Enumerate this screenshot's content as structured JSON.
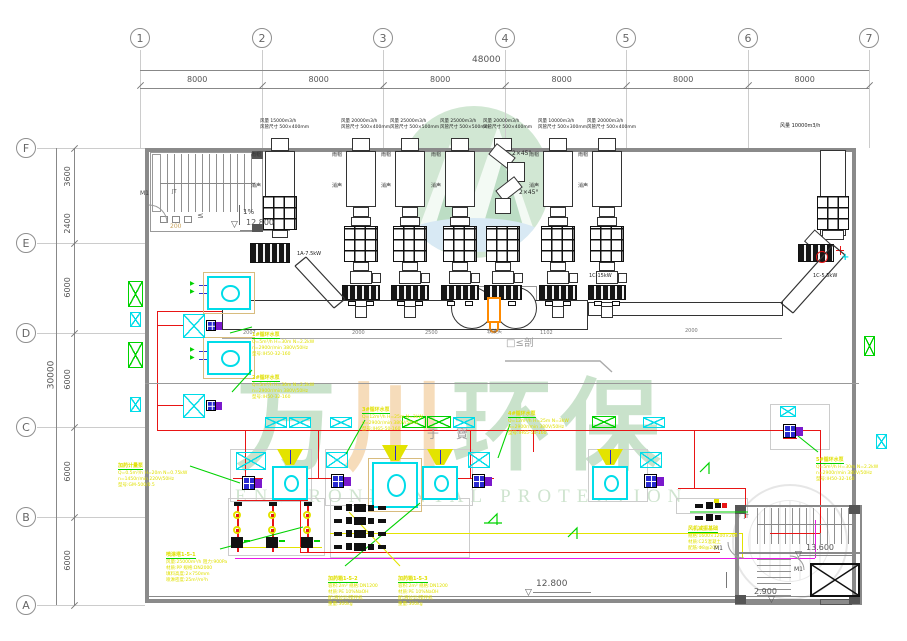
{
  "grid": {
    "cols": [
      {
        "label": "1",
        "x": 140
      },
      {
        "label": "2",
        "x": 262
      },
      {
        "label": "3",
        "x": 383
      },
      {
        "label": "4",
        "x": 505
      },
      {
        "label": "5",
        "x": 626
      },
      {
        "label": "6",
        "x": 748
      },
      {
        "label": "7",
        "x": 869
      }
    ],
    "col_dims": [
      "8000",
      "8000",
      "8000",
      "8000",
      "8000",
      "8000"
    ],
    "col_total": "48000",
    "rows": [
      {
        "label": "F",
        "y": 148
      },
      {
        "label": "E",
        "y": 243
      },
      {
        "label": "D",
        "y": 333
      },
      {
        "label": "C",
        "y": 427
      },
      {
        "label": "B",
        "y": 517
      },
      {
        "label": "A",
        "y": 605
      }
    ],
    "row_dims": [
      {
        "label": "3600",
        "y1": 148,
        "y2": 205
      },
      {
        "label": "2400",
        "y1": 205,
        "y2": 243
      },
      {
        "label": "6000",
        "y1": 243,
        "y2": 333
      },
      {
        "label": "6000",
        "y1": 333,
        "y2": 427
      },
      {
        "label": "6000",
        "y1": 427,
        "y2": 517
      },
      {
        "label": "6000",
        "y1": 517,
        "y2": 605
      }
    ],
    "row_total": "30000"
  },
  "watermark": {
    "cn": [
      {
        "ch": "万",
        "x": 236,
        "color": "#c9e2cb"
      },
      {
        "ch": "川",
        "x": 344,
        "color": "#f6dcba"
      },
      {
        "ch": "环",
        "x": 452,
        "color": "#c9e2cb"
      },
      {
        "ch": "保",
        "x": 560,
        "color": "#c9e2cb"
      }
    ],
    "en": "ENVIRONMENTAL PROTECTION"
  },
  "tower_side": [
    "雨帽",
    "消声"
  ],
  "towers": [
    {
      "x": 280,
      "flow": "风量 15000m3/h",
      "duct": "风管尺寸 500×400mm",
      "type": "short"
    },
    {
      "x": 361,
      "flow": "风量 20000m3/h",
      "duct": "风管尺寸 500×400mm",
      "type": "std"
    },
    {
      "x": 410,
      "flow": "风量 25000m3/h",
      "duct": "风管尺寸 500×500mm",
      "type": "std"
    },
    {
      "x": 460,
      "flow": "风量 25000m3/h",
      "duct": "风管尺寸 500×500mm",
      "type": "std"
    },
    {
      "x": 503,
      "flow": "风量 20000m3/h",
      "duct": "风管尺寸 500×400mm",
      "type": "bend"
    },
    {
      "x": 558,
      "flow": "风量 10000m3/h",
      "duct": "风管尺寸 500×300mm",
      "type": "std"
    },
    {
      "x": 607,
      "flow": "风量 20000m3/h",
      "duct": "风管尺寸 500×400mm",
      "type": "std"
    }
  ],
  "texts": [
    {
      "n": "stair1-door-label",
      "t": "M1",
      "x": 140,
      "y": 191,
      "s": 6,
      "c": "#444"
    },
    {
      "n": "stair1-label",
      "t": "JT",
      "x": 172,
      "y": 190,
      "s": 5,
      "c": "#555"
    },
    {
      "n": "stair1-leq",
      "t": "≤",
      "x": 197,
      "y": 212,
      "s": 8,
      "c": "#666"
    },
    {
      "n": "stair1-num",
      "t": "200",
      "x": 170,
      "y": 224,
      "s": 6,
      "c": "#c8a25a"
    },
    {
      "n": "slope-label",
      "t": "1%",
      "x": 243,
      "y": 209,
      "s": 7,
      "c": "#444"
    },
    {
      "n": "elevation-stair1",
      "t": "12.800",
      "x": 246,
      "y": 219,
      "s": 8,
      "c": "#555"
    },
    {
      "n": "elevation-bottom",
      "t": "12.800",
      "x": 536,
      "y": 580,
      "s": 9,
      "c": "#555"
    },
    {
      "n": "elevation-stair2-top",
      "t": "13.600",
      "x": 806,
      "y": 544,
      "s": 8,
      "c": "#555"
    },
    {
      "n": "elevation-stair2-mid",
      "t": "2.900",
      "x": 754,
      "y": 588,
      "s": 8,
      "c": "#555"
    },
    {
      "n": "stair2-door1-label",
      "t": "M1",
      "x": 714,
      "y": 546,
      "s": 6,
      "c": "#444"
    },
    {
      "n": "stair2-door2-label",
      "t": "M1",
      "x": 794,
      "y": 567,
      "s": 6,
      "c": "#444"
    },
    {
      "n": "stair2-label",
      "t": "JT",
      "x": 744,
      "y": 515,
      "s": 5,
      "c": "#555"
    },
    {
      "n": "fan-label-left",
      "t": "1A-7.5kW",
      "x": 297,
      "y": 252,
      "s": 5,
      "c": "#222"
    },
    {
      "n": "fan-label-tower",
      "t": "1C-15kW",
      "x": 589,
      "y": 274,
      "s": 5,
      "c": "#222"
    },
    {
      "n": "fan-label-right",
      "t": "1C-5.5kW",
      "x": 813,
      "y": 274,
      "s": 5,
      "c": "#222"
    },
    {
      "n": "right-duct-flow",
      "t": "风量 10000m3/h",
      "x": 780,
      "y": 124,
      "s": 5,
      "c": "#222"
    },
    {
      "n": "connector-label",
      "t": "软接头",
      "x": 487,
      "y": 330,
      "s": 5,
      "c": "#666"
    },
    {
      "n": "section-mark",
      "t": "□≤剖",
      "x": 506,
      "y": 338,
      "s": 10,
      "c": "#9c9c9c"
    },
    {
      "n": "gray-glyph-1",
      "t": "于",
      "x": 427,
      "y": 428,
      "s": 12,
      "c": "#9c9c9c"
    },
    {
      "n": "gray-glyph-2",
      "t": "寶",
      "x": 456,
      "y": 428,
      "s": 12,
      "c": "#9c9c9c"
    },
    {
      "n": "duct-dim",
      "t": "2007",
      "x": 243,
      "y": 331,
      "s": 5,
      "c": "#777"
    },
    {
      "n": "duct-dim",
      "t": "2000",
      "x": 352,
      "y": 331,
      "s": 5,
      "c": "#777"
    },
    {
      "n": "duct-dim",
      "t": "2500",
      "x": 425,
      "y": 331,
      "s": 5,
      "c": "#777"
    },
    {
      "n": "duct-dim",
      "t": "1102",
      "x": 540,
      "y": 331,
      "s": 5,
      "c": "#777"
    },
    {
      "n": "duct-dim",
      "t": "2000",
      "x": 685,
      "y": 329,
      "s": 5,
      "c": "#777"
    },
    {
      "n": "bend-label",
      "t": "2×45°",
      "x": 512,
      "y": 151,
      "s": 6,
      "c": "#222"
    },
    {
      "n": "bend-label",
      "t": "2×45°",
      "x": 519,
      "y": 190,
      "s": 6,
      "c": "#222"
    },
    {
      "n": "elev-triangle",
      "t": "▽",
      "x": 231,
      "y": 221,
      "s": 9,
      "c": "#555"
    },
    {
      "n": "elev-triangle",
      "t": "▽",
      "x": 525,
      "y": 589,
      "s": 9,
      "c": "#555"
    },
    {
      "n": "elev-triangle",
      "t": "▽",
      "x": 795,
      "y": 551,
      "s": 9,
      "c": "#555"
    },
    {
      "n": "elev-triangle",
      "t": "▽",
      "x": 768,
      "y": 596,
      "s": 9,
      "c": "#555"
    },
    {
      "n": "cyan-plus",
      "t": "+",
      "x": 841,
      "y": 252,
      "s": 10,
      "c": "#00dce8",
      "b": 1
    },
    {
      "n": "green-arrow",
      "t": "▶",
      "x": 190,
      "y": 281,
      "s": 6,
      "c": "#00d200"
    },
    {
      "n": "green-arrow",
      "t": "▶",
      "x": 190,
      "y": 289,
      "s": 6,
      "c": "#00d200"
    },
    {
      "n": "green-arrow",
      "t": "▶",
      "x": 190,
      "y": 347,
      "s": 6,
      "c": "#00d200"
    },
    {
      "n": "green-arrow",
      "t": "▶",
      "x": 190,
      "y": 355,
      "s": 6,
      "c": "#00d200"
    }
  ],
  "annotations": [
    {
      "x": 252,
      "y": 321,
      "title": "1#循环水泵",
      "lines": [
        "Q=5m³/h H=30m N=2.2kW",
        "n=2900r/min 380V/50Hz",
        "型号:IH50-32-160"
      ]
    },
    {
      "x": 252,
      "y": 364,
      "title": "2#循环水泵",
      "lines": [
        "Q=5m³/h H=30m N=2.2kW",
        "n=2900r/min 380V/50Hz",
        "型号:IH50-32-160"
      ]
    },
    {
      "x": 118,
      "y": 452,
      "title": "加药计量泵",
      "lines": [
        "Q=0.5m³/h H=20m N=0.75kW",
        "n=1450r/min 220V/50Hz",
        "型号:GM-500/0.5"
      ]
    },
    {
      "x": 362,
      "y": 396,
      "title": "3#循环水泵",
      "lines": [
        "Q=12m³/h H=25m N=3kW",
        "n=2900r/min 380V/50Hz",
        "型号:IH65-50-160"
      ]
    },
    {
      "x": 508,
      "y": 400,
      "title": "4#循环水泵",
      "lines": [
        "Q=12m³/h H=25m N=3kW",
        "n=2900r/min 380V/50Hz",
        "型号:IH65-50-160"
      ]
    },
    {
      "x": 816,
      "y": 446,
      "title": "5#循环水泵",
      "lines": [
        "Q=5m³/h H=30m N=2.2kW",
        "n=2900r/min 380V/50Hz",
        "型号:IH50-32-160"
      ]
    },
    {
      "x": 166,
      "y": 541,
      "title": "喷淋塔1-5-1",
      "lines": [
        "风量:25000m³/h 阻力:900Pa",
        "材质:PP 规格:DN2000",
        "填料高度:2×750mm",
        "喷淋密度:25m³/m²h"
      ]
    },
    {
      "x": 328,
      "y": 565,
      "title": "加药箱1-5-2",
      "lines": [
        "容积:2m³ 规格:DN1200",
        "材质:PE 10%NaOH",
        "配:液位计/搅拌机",
        "重量:300kg"
      ]
    },
    {
      "x": 398,
      "y": 565,
      "title": "加药箱1-5-3",
      "lines": [
        "容积:2m³ 规格:DN1200",
        "材质:PE 10%NaOH",
        "配:液位计/搅拌机",
        "重量:300kg"
      ]
    },
    {
      "x": 688,
      "y": 515,
      "title": "风机减振基础",
      "lines": [
        "规格:1600×1200×200",
        "材质:C25混凝土",
        "配筋:Φ8@200"
      ]
    }
  ],
  "leaders": [
    [
      252,
      327,
      230,
      333,
      "g"
    ],
    [
      252,
      370,
      232,
      392,
      "g"
    ],
    [
      190,
      466,
      240,
      483,
      "g"
    ],
    [
      365,
      420,
      346,
      454,
      "g"
    ],
    [
      510,
      424,
      498,
      458,
      "g"
    ],
    [
      818,
      452,
      798,
      436,
      "g"
    ],
    [
      220,
      549,
      303,
      527,
      "g"
    ],
    [
      345,
      566,
      420,
      503,
      "g"
    ],
    [
      400,
      566,
      349,
      512,
      "y"
    ],
    [
      690,
      512,
      748,
      512,
      "g"
    ]
  ],
  "xboxes": [
    [
      128,
      281,
      15,
      26,
      "green"
    ],
    [
      130,
      312,
      11,
      15,
      "cyan"
    ],
    [
      128,
      342,
      15,
      26,
      "green"
    ],
    [
      130,
      397,
      11,
      15,
      "cyan"
    ],
    [
      183,
      314,
      22,
      24,
      "cyan"
    ],
    [
      183,
      394,
      22,
      24,
      "cyan"
    ],
    [
      265,
      417,
      22,
      11,
      "cyan"
    ],
    [
      289,
      417,
      22,
      11,
      "cyan"
    ],
    [
      330,
      417,
      22,
      11,
      "cyan"
    ],
    [
      402,
      416,
      24,
      12,
      "green"
    ],
    [
      427,
      416,
      24,
      12,
      "green"
    ],
    [
      453,
      417,
      22,
      11,
      "cyan"
    ],
    [
      592,
      416,
      24,
      12,
      "green"
    ],
    [
      643,
      417,
      22,
      11,
      "cyan"
    ],
    [
      780,
      406,
      16,
      11,
      "cyan"
    ],
    [
      864,
      336,
      11,
      20,
      "green"
    ],
    [
      876,
      434,
      11,
      15,
      "cyan"
    ],
    [
      236,
      452,
      30,
      18,
      "cyan"
    ],
    [
      326,
      452,
      22,
      16,
      "cyan"
    ],
    [
      468,
      452,
      22,
      16,
      "cyan"
    ],
    [
      640,
      452,
      22,
      16,
      "cyan"
    ]
  ],
  "blowers": [
    {
      "x": 207,
      "y": 276,
      "w": 44,
      "h": 34,
      "case": true
    },
    {
      "x": 207,
      "y": 341,
      "w": 44,
      "h": 34,
      "case": true
    },
    {
      "x": 272,
      "y": 466,
      "w": 36,
      "h": 34,
      "funnel": true
    },
    {
      "x": 372,
      "y": 462,
      "w": 46,
      "h": 46,
      "funnel": true,
      "case": true
    },
    {
      "x": 422,
      "y": 466,
      "w": 36,
      "h": 34,
      "funnel": true
    },
    {
      "x": 592,
      "y": 466,
      "w": 36,
      "h": 34,
      "funnel": true
    }
  ],
  "pumps": [
    {
      "x": 242,
      "y": 476
    },
    {
      "x": 331,
      "y": 474
    },
    {
      "x": 472,
      "y": 474
    },
    {
      "x": 644,
      "y": 474
    },
    {
      "x": 783,
      "y": 424
    },
    {
      "x": 206,
      "y": 320,
      "sm": true
    },
    {
      "x": 206,
      "y": 400,
      "sm": true
    }
  ],
  "manifolds": {
    "xs": [
      237,
      272,
      307
    ],
    "top": 505,
    "h": 47
  },
  "valve_rows": {
    "ys": [
      504,
      517,
      530,
      543
    ],
    "x": 334
  },
  "right_cluster": {
    "x": 695,
    "ys": [
      502,
      514
    ]
  },
  "pipes": [
    [
      157,
      311,
      166,
      1,
      "#e81515"
    ],
    [
      157,
      311,
      1,
      120,
      "#e81515"
    ],
    [
      158,
      325,
      26,
      1,
      "#e81515"
    ],
    [
      158,
      405,
      26,
      1,
      "#e81515"
    ],
    [
      157,
      430,
      663,
      1,
      "#e81515"
    ],
    [
      245,
      430,
      1,
      48,
      "#e81515"
    ],
    [
      233,
      478,
      30,
      1,
      "#e81515"
    ],
    [
      318,
      430,
      1,
      48,
      "#e81515"
    ],
    [
      302,
      478,
      32,
      1,
      "#e81515"
    ],
    [
      470,
      430,
      1,
      48,
      "#e81515"
    ],
    [
      452,
      478,
      42,
      1,
      "#e81515"
    ],
    [
      533,
      430,
      1,
      22,
      "#e81515"
    ],
    [
      694,
      430,
      1,
      58,
      "#e81515"
    ],
    [
      678,
      488,
      67,
      1,
      "#e81515"
    ],
    [
      745,
      488,
      1,
      30,
      "#e81515"
    ],
    [
      820,
      430,
      1,
      103,
      "#e81515"
    ],
    [
      770,
      533,
      50,
      1,
      "#e81515"
    ],
    [
      300,
      500,
      1,
      52,
      "#e81515"
    ],
    [
      300,
      552,
      420,
      1,
      "#e81515"
    ],
    [
      237,
      500,
      71,
      1,
      "#e81515"
    ],
    [
      783,
      438,
      14,
      1,
      "#e81515"
    ],
    [
      330,
      533,
      412,
      1,
      "#e3e300"
    ],
    [
      742,
      533,
      1,
      25,
      "#e3e300"
    ],
    [
      237,
      547,
      85,
      1,
      "#e3e300"
    ],
    [
      235,
      558,
      580,
      1,
      "#e818e8"
    ],
    [
      815,
      520,
      1,
      38,
      "#e818e8"
    ],
    [
      199,
      285,
      9,
      1,
      "#3333cc"
    ],
    [
      199,
      293,
      9,
      1,
      "#3333cc"
    ],
    [
      199,
      351,
      9,
      1,
      "#3333cc"
    ],
    [
      199,
      359,
      9,
      1,
      "#3333cc"
    ],
    [
      240,
      230,
      50,
      1,
      "#888"
    ],
    [
      533,
      592,
      58,
      1,
      "#888"
    ],
    [
      800,
      555,
      55,
      1,
      "#888"
    ],
    [
      752,
      599,
      42,
      1,
      "#888"
    ],
    [
      222,
      338,
      560,
      1,
      "#aaa"
    ],
    [
      222,
      314,
      366,
      1,
      "#ccc"
    ],
    [
      588,
      309,
      170,
      1,
      "#ccc"
    ],
    [
      145,
      383,
      714,
      1,
      "#999"
    ],
    [
      737,
      505,
      123,
      2,
      "#8a8a8a"
    ],
    [
      737,
      505,
      2,
      100,
      "#8a8a8a"
    ],
    [
      737,
      552,
      125,
      2,
      "#8a8a8a"
    ],
    [
      255,
      300,
      1,
      30,
      "#444"
    ],
    [
      300,
      300,
      1,
      30,
      "#444"
    ],
    [
      332,
      300,
      1,
      30,
      "#444"
    ],
    [
      360,
      300,
      1,
      30,
      "#444"
    ],
    [
      430,
      300,
      1,
      30,
      "#444"
    ],
    [
      540,
      300,
      1,
      30,
      "#444"
    ],
    [
      650,
      302,
      1,
      14,
      "#444"
    ],
    [
      720,
      302,
      1,
      14,
      "#444"
    ],
    [
      451,
      308,
      42,
      1,
      "#555"
    ],
    [
      495,
      308,
      42,
      1,
      "#555"
    ],
    [
      836,
      250,
      8,
      1,
      "#e81515"
    ],
    [
      840,
      246,
      1,
      9,
      "#e81515"
    ],
    [
      726,
      572,
      1,
      16,
      "#777"
    ],
    [
      160,
      183,
      95,
      1,
      "#888"
    ],
    [
      757,
      524,
      96,
      1,
      "#888"
    ]
  ],
  "outlines": [
    [
      230,
      449,
      82,
      53,
      "#cccccc"
    ],
    [
      325,
      449,
      148,
      57,
      "#cccccc"
    ],
    [
      588,
      449,
      60,
      53,
      "#cccccc"
    ],
    [
      676,
      498,
      72,
      16,
      "#cccccc"
    ],
    [
      228,
      498,
      97,
      58,
      "#cccccc"
    ],
    [
      330,
      498,
      140,
      60,
      "#cccccc"
    ],
    [
      770,
      404,
      60,
      46,
      "#cccccc"
    ],
    [
      449,
      286,
      44,
      44,
      "#999999"
    ],
    [
      493,
      286,
      44,
      44,
      "#999999"
    ]
  ],
  "colors": {
    "green": "#00d200",
    "cyan": "#00dce8",
    "red": "#e81515",
    "yellow": "#e3e300",
    "magenta": "#e818e8",
    "orange": "#ff8a00",
    "tan": "#d8bc7e",
    "blue": "#2a2ad0",
    "purple": "#7a18cc"
  }
}
